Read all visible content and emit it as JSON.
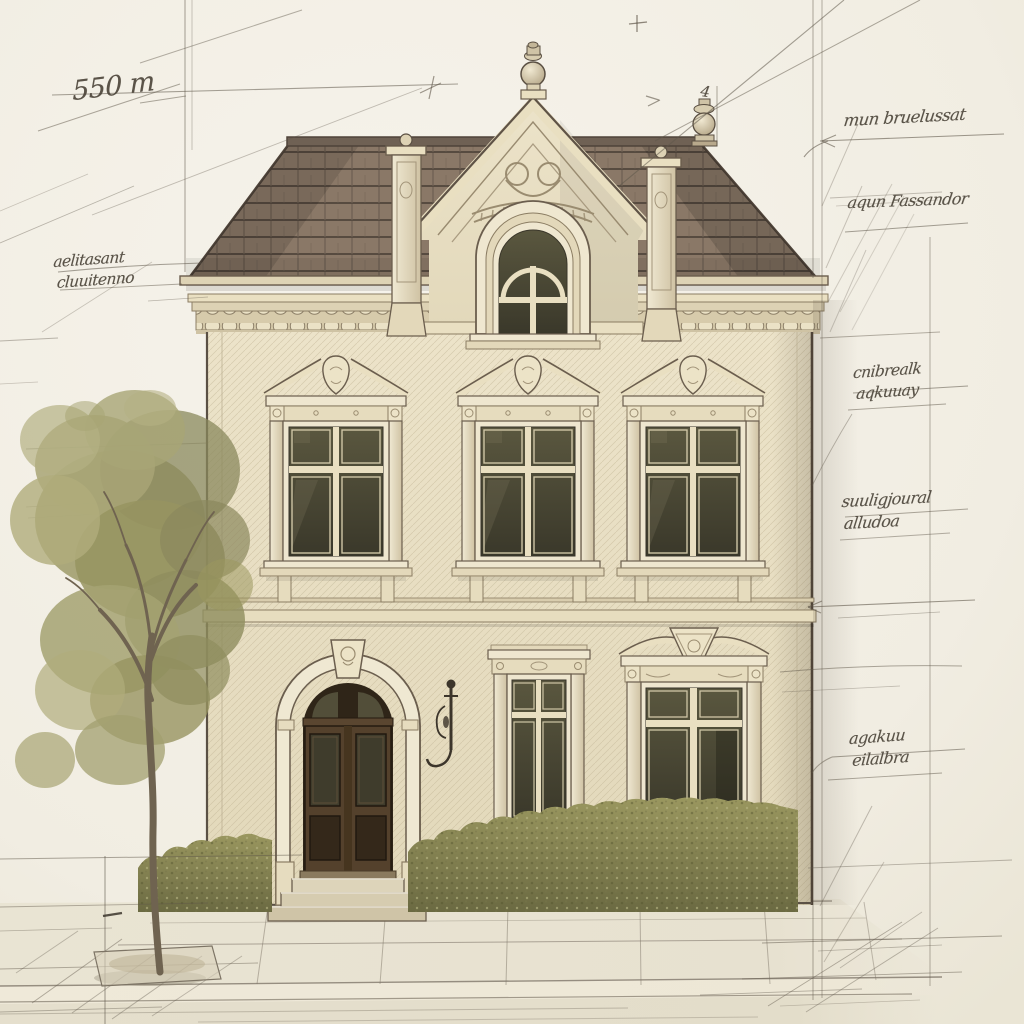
{
  "annotations": {
    "dimension_note": "550 m",
    "corner_mark": "4",
    "left_note": {
      "line1": "aelitasant",
      "line2": "cluuitenno"
    },
    "right_notes": [
      {
        "line1": "mun bruelussat",
        "line2": ""
      },
      {
        "line1": "aqun Fassandor",
        "line2": ""
      },
      {
        "line1": "cnibrealk",
        "line2": "aqkuuay"
      },
      {
        "line1": "suuligjoural",
        "line2": "alludoa"
      },
      {
        "line1": "agakuu",
        "line2": "eilalbra"
      }
    ]
  },
  "palette": {
    "paper": "#f3f0e7",
    "wall": "#e9e0c4",
    "trim": "#efe8d2",
    "roof_tile": "#877565",
    "door_wood": "#4f3d2a",
    "window_glass": "#45422f",
    "hedge_green": "#8f8c58",
    "tree_foliage": "#a5a272",
    "pencil": "#5d5449",
    "ink": "#463f35"
  }
}
